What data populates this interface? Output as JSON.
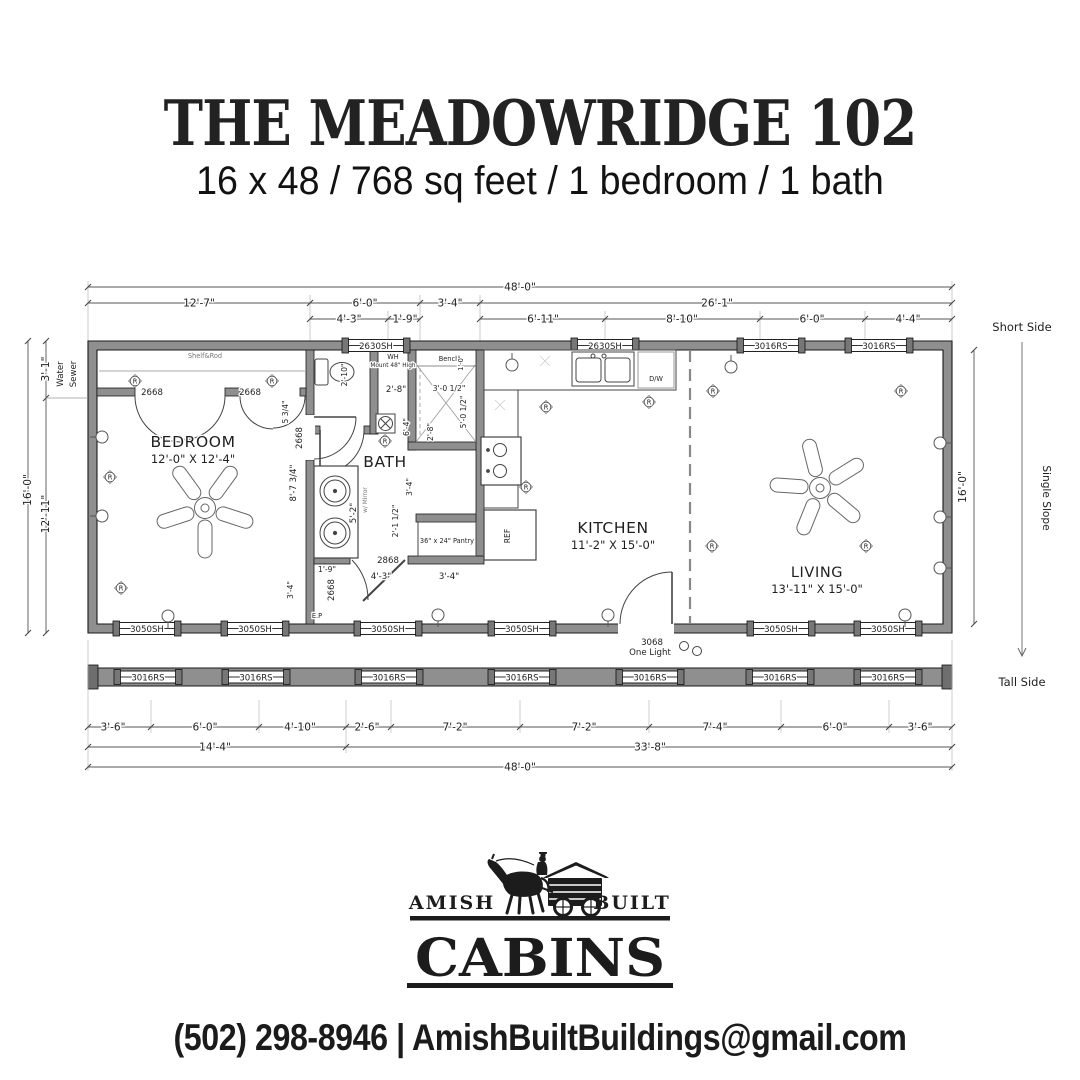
{
  "header": {
    "title": "THE MEADOWRIDGE 102",
    "subtitle": "16 x 48 / 768 sq feet / 1 bedroom / 1 bath"
  },
  "plan": {
    "overall_width": "48'-0\"",
    "dims_top_row1": [
      "12'-7\"",
      "6'-0\"",
      "3'-4\"",
      "26'-1\""
    ],
    "dims_top_row2": [
      "4'-3\"",
      "1'-9\"",
      "6'-11\"",
      "8'-10\"",
      "6'-0\"",
      "4'-4\""
    ],
    "dims_bottom_row1": [
      "3'-6\"",
      "6'-0\"",
      "4'-10\"",
      "2'-6\"",
      "7'-2\"",
      "7'-2\"",
      "7'-4\"",
      "6'-0\"",
      "3'-6\""
    ],
    "dims_bottom_row2": [
      "14'-4\"",
      "33'-8\""
    ],
    "dims_left": {
      "top": "3'-1\"",
      "overall": "16'-0\"",
      "lower": "12'-11\"",
      "water": "Water",
      "sewer": "Sewer"
    },
    "dims_right": {
      "overall": "16'-0\""
    },
    "slope": {
      "short": "Short Side",
      "label": "Single Slope",
      "tall": "Tall Side"
    },
    "rooms": {
      "bedroom": {
        "name": "BEDROOM",
        "size": "12'-0\" X 12'-4\""
      },
      "bath": {
        "name": "BATH"
      },
      "kitchen": {
        "name": "KITCHEN",
        "size": "11'-2\" X 15'-0\""
      },
      "living": {
        "name": "LIVING",
        "size": "13'-11\" X 15'-0\""
      }
    },
    "windows": {
      "w2630": "2630SH",
      "w3016": "3016RS",
      "w3050": "3050SH"
    },
    "doors": {
      "closet": "2668",
      "bedroom": "2668",
      "hall": "2668",
      "bath": "2868",
      "entry_size": "3068",
      "entry_type": "One Light"
    },
    "notes": {
      "shelf": "Shelf&Rod",
      "wh1": "WH",
      "wh2": "Mount 48\" High",
      "toilet": "2'-10\"",
      "toilet_wall": "2'-8\"",
      "bench": "Bench",
      "bench_d": "1'-0\"",
      "shower_w": "3'-0 1/2\"",
      "shower_h": "5'-0 1/2\"",
      "shower_d": "2'-8\"",
      "bath_len": "6'-4\"",
      "vanity_h": "8'-7 3/4\"",
      "vanity_w": "5'-2\"",
      "mirror": "w/ Mirror",
      "d1": "3'-4\"",
      "d2": "2'-1 1/2\"",
      "pantry": "36\" x 24\" Pantry",
      "h1": "1'-9\"",
      "h2": "4'-3\"",
      "h3": "3'-4\"",
      "h4": "3'-4\"",
      "h5": "5 3/4\"",
      "ep": "E.P",
      "dw": "D/W",
      "ref": "REF",
      "recep": "R"
    }
  },
  "footer": {
    "brand_left": "AMISH",
    "brand_right": "BUILT",
    "brand_main": "CABINS",
    "contact": "(502) 298-8946 | AmishBuiltBuildings@gmail.com"
  }
}
